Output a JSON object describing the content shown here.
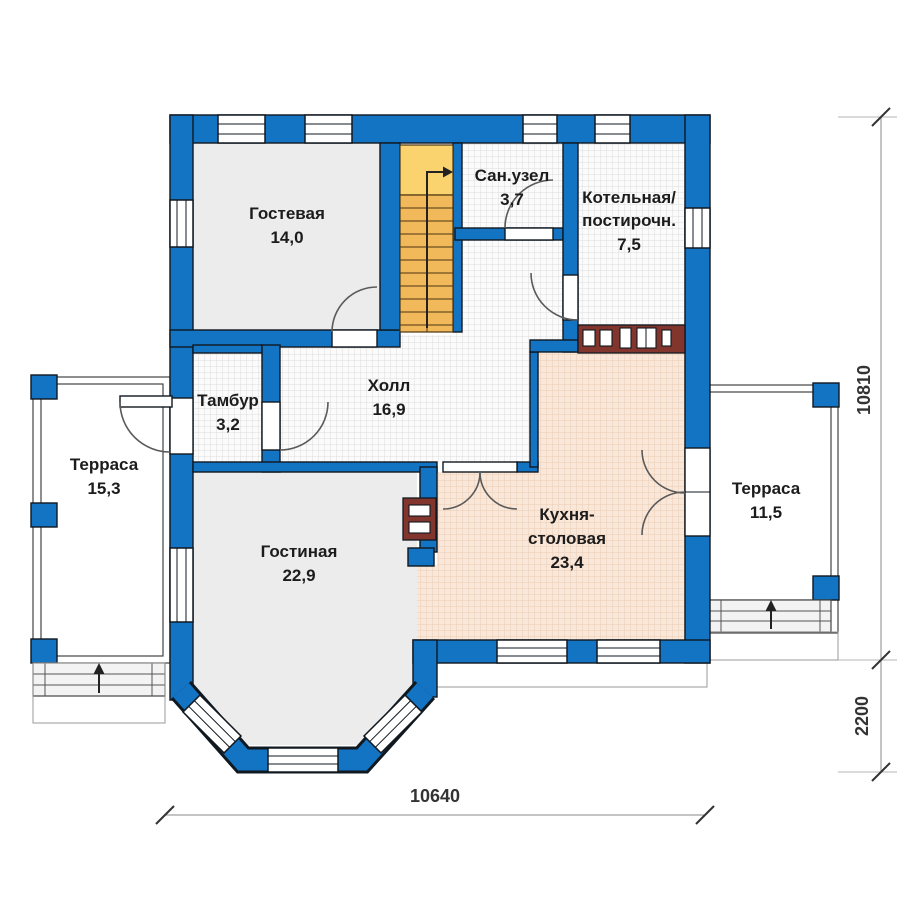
{
  "plan": {
    "type": "house-floor-plan",
    "floor": "first-floor"
  },
  "colors": {
    "wall_blue": "#1474c4",
    "stairs_orange": "#f2b95b",
    "stairs_landing": "#fbd36e",
    "counter_red": "#82352c",
    "room_plain_gray": "#ececec",
    "kitchen_pink": "#f9e8da"
  },
  "rooms": [
    {
      "name": "Гостевая",
      "area": "14,0"
    },
    {
      "name": "Сан.узел",
      "area": "3,7"
    },
    {
      "name": "Котельная/",
      "name2": "постирочн.",
      "area": "7,5"
    },
    {
      "name": "Холл",
      "area": "16,9"
    },
    {
      "name": "Тамбур",
      "area": "3,2"
    },
    {
      "name": "Терраса",
      "area": "15,3"
    },
    {
      "name": "Гостиная",
      "area": "22,9"
    },
    {
      "name": "Кухня-",
      "name2": "столовая",
      "area": "23,4"
    },
    {
      "name": "Терраса",
      "area": "11,5"
    }
  ],
  "dimensions": {
    "bottom": "10640",
    "right_upper": "10810",
    "right_lower": "2200"
  }
}
